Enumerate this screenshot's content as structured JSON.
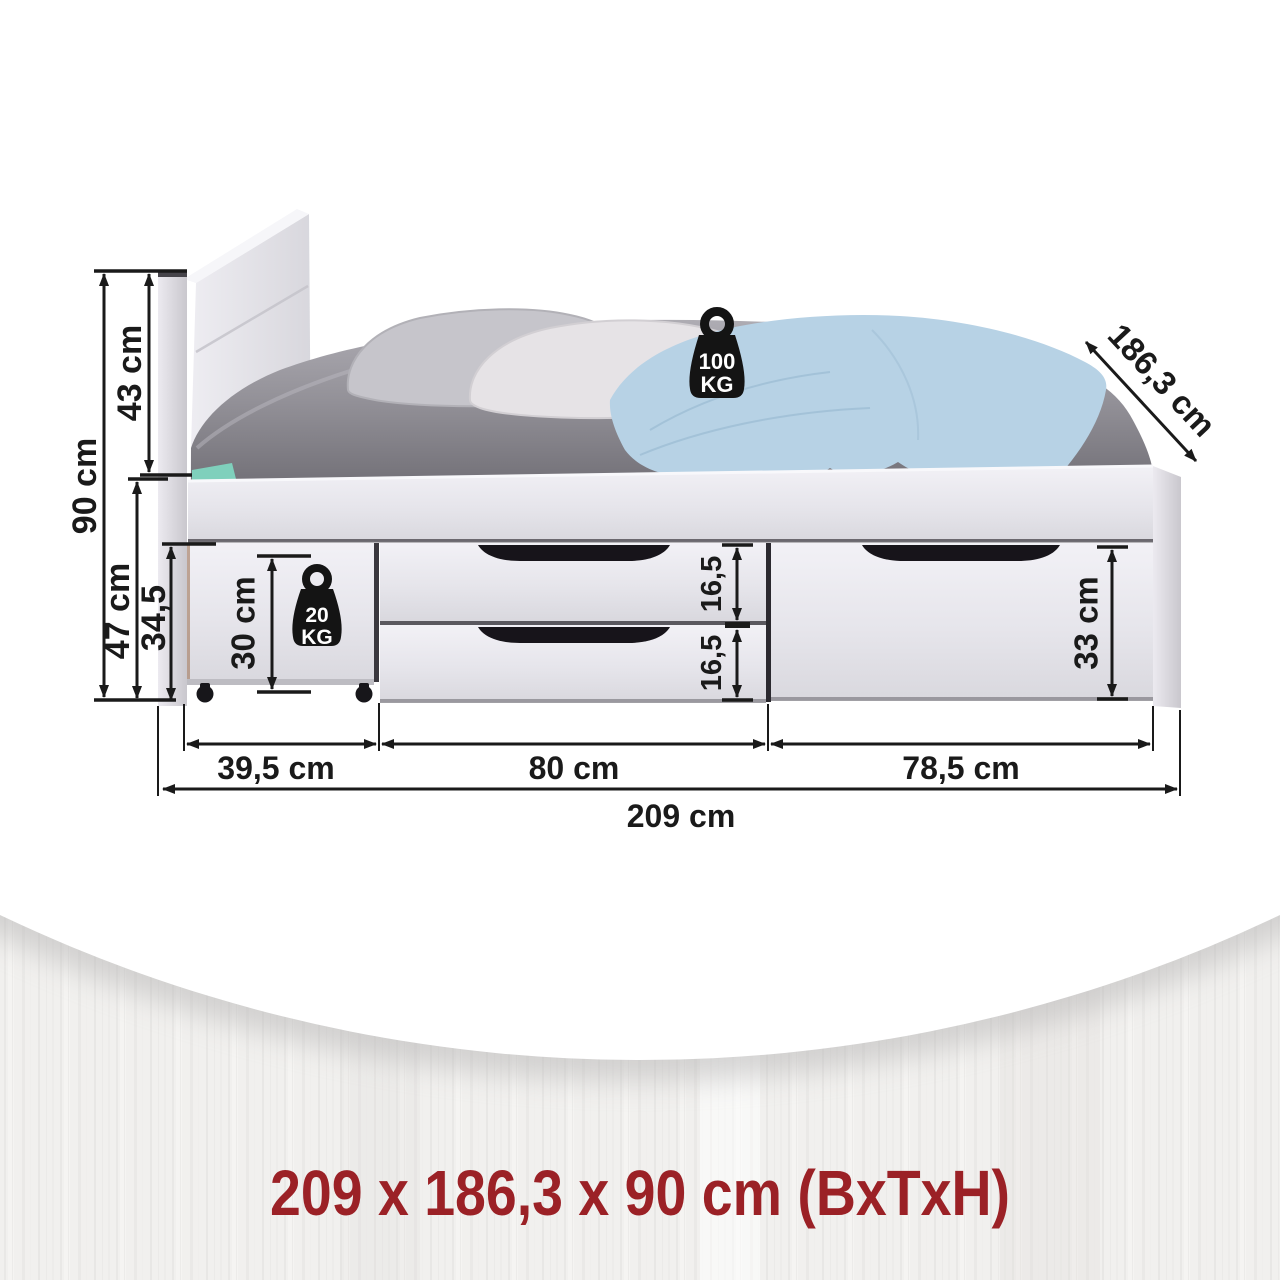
{
  "diagram": {
    "summary": "209 x 186,3 x 90 cm (BxTxH)",
    "labels": {
      "total_height": "90 cm",
      "headboard_height": "43 cm",
      "base_height": "47 cm",
      "drawer_front_height": "34,5",
      "rollout_drawer_inner_height": "30 cm",
      "middle_drawer_top_height": "16,5",
      "middle_drawer_bottom_height": "16,5",
      "right_drawer_height": "33 cm",
      "depth": "186,3 cm",
      "rollout_drawer_width": "39,5 cm",
      "middle_drawers_width": "80 cm",
      "right_drawer_width": "78,5 cm",
      "total_width": "209 cm"
    },
    "max_load_bed": {
      "value": "100",
      "unit": "KG"
    },
    "max_load_drawer": {
      "value": "20",
      "unit": "KG"
    },
    "colors": {
      "dimension_lines": "#1a1a1a",
      "summary_text": "#9b2126",
      "blanket": "#b7d2e5",
      "mattress": "#8b8990",
      "furniture": "#e7e6ec"
    }
  }
}
